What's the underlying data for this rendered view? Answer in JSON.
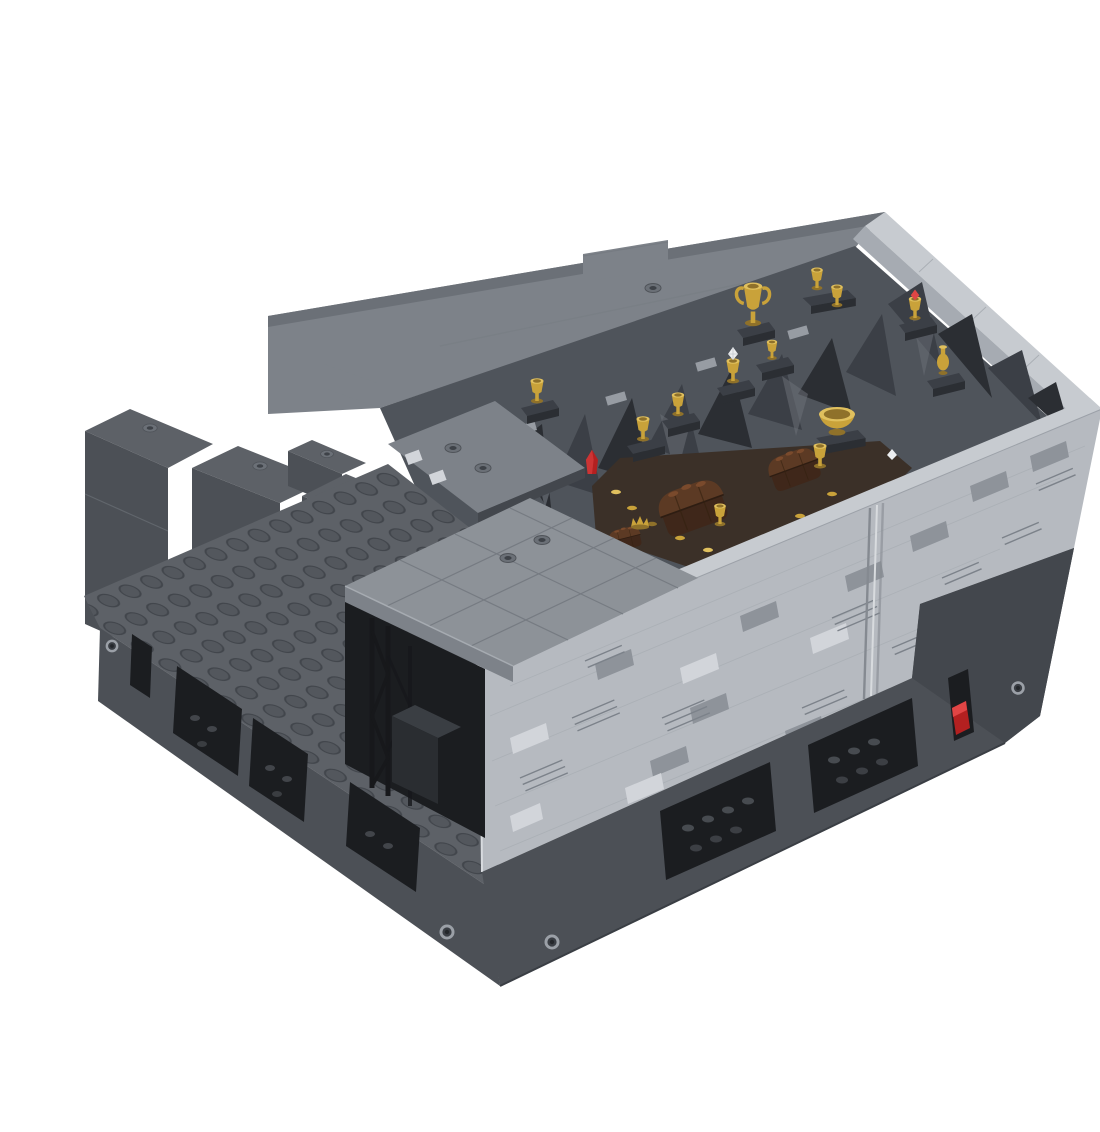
{
  "meta": {
    "title": "LEGO MOC stone treasure vault model - isometric product render",
    "description": "Computer render of a gray LEGO brick model on a white background: an L-shaped dark bluish gray studded base holds a light gray masonry vault building with an open top revealing a rocky cave interior filled with gold goblets, a trophy cup, a chalice with a diamond, urns, a large gold basin, brown treasure chests, coins and red crystals. A flat tiled roof covers the left wing, a black lattice truss stands in a tall dark opening, and the base has rectangular openings, a red lever slot and light gray Technic pins."
  },
  "scene": {
    "type": "product-render",
    "view": "isometric",
    "objects": [
      {
        "name": "studded-base-platform",
        "color": "dark-bluish-gray"
      },
      {
        "name": "stepped-back-walls",
        "color": "dark-bluish-gray",
        "count": 4
      },
      {
        "name": "vault-building",
        "color": "light-bluish-gray",
        "texture": "masonry-profile-bricks"
      },
      {
        "name": "door-seam",
        "location": "front-wall-right"
      },
      {
        "name": "flat-tiled-roof",
        "color": "medium-gray",
        "hollow_studs": 4
      },
      {
        "name": "black-lattice-truss",
        "location": "left-opening"
      },
      {
        "name": "base-openings",
        "count": 6
      },
      {
        "name": "red-lever-slot",
        "count": 1
      },
      {
        "name": "technic-pins",
        "count": 4
      },
      {
        "name": "rock-cave-interior",
        "color": "dark-gray"
      },
      {
        "name": "gold-goblets",
        "count": 8
      },
      {
        "name": "trophy-cup",
        "count": 1
      },
      {
        "name": "chalice-with-diamond",
        "count": 1
      },
      {
        "name": "goblet-with-red-gem",
        "count": 1
      },
      {
        "name": "gold-urn",
        "count": 1
      },
      {
        "name": "gold-basin",
        "count": 1
      },
      {
        "name": "treasure-chests",
        "count": 3,
        "color": "reddish-brown"
      },
      {
        "name": "gold-crown",
        "count": 1
      },
      {
        "name": "red-crystal",
        "count": 1
      },
      {
        "name": "gold-coins",
        "count": 9
      }
    ]
  },
  "colors": {
    "background": "#ffffff",
    "light_wall": "#b6bac0",
    "light_wall_shade": "#a6abb2",
    "light_wall_bright": "#d2d5da",
    "wall_patch": "#8e939a",
    "wall_groove": "#7c828a",
    "wall_joint": "#a9aeb4",
    "coping": "#c7cbd0",
    "roof": "#8d9298",
    "roof_line": "#767b82",
    "back_band": "#7d8289",
    "dark_top": "#5d6167",
    "dark_face": "#4c5056",
    "dark_face2": "#43474d",
    "dark_shadow": "#33363c",
    "opening": "#1b1d20",
    "stud": "#53575d",
    "stud_dark": "#42464c",
    "rock": "#4f545b",
    "rock_dark": "#3b3f46",
    "rock_deep": "#2b2e33",
    "rock_light": "#6b7077",
    "rock_pale": "#979ca3",
    "floor_brown": "#3b3028",
    "gold": "#c9a23a",
    "gold_light": "#e0c05e",
    "gold_dark": "#8f712a",
    "brown": "#5c3a24",
    "brown_light": "#7a4a2c",
    "brown_dark": "#3f271a",
    "red": "#b32020",
    "red_light": "#e04545",
    "truss_black": "#17181b",
    "white_gem": "#eceef0",
    "pin": "#9ba0a7",
    "seam_dark": "#858a91",
    "seam_light": "#d8dbde"
  }
}
